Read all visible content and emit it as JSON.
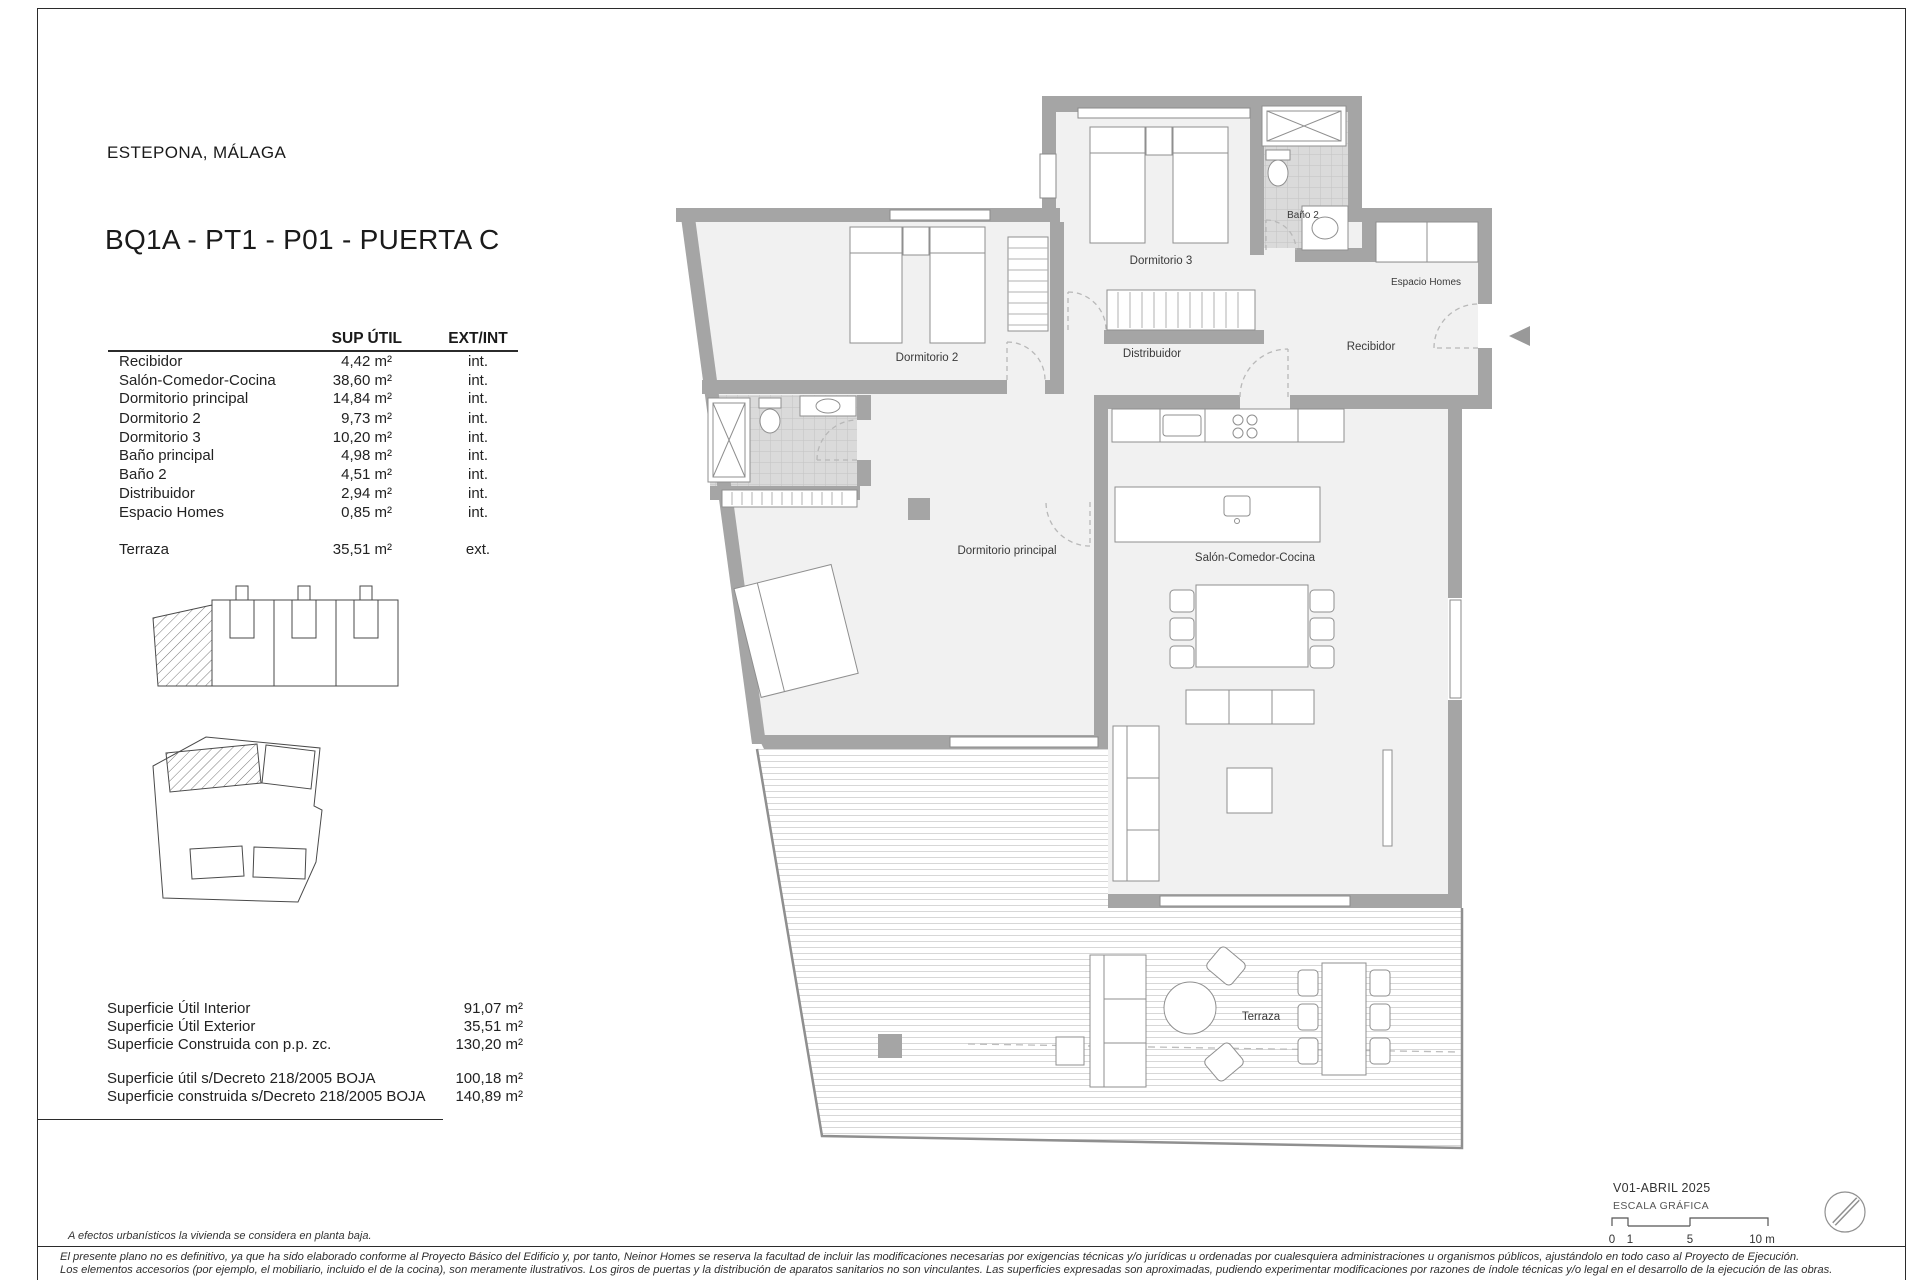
{
  "page": {
    "location": "ESTEPONA, MÁLAGA",
    "title": "BQ1A - PT1 - P01 -  PUERTA C"
  },
  "area_table": {
    "col_sup": "SUP ÚTIL",
    "col_extint": "EXT/INT",
    "rows": [
      {
        "label": "Recibidor",
        "value": "4,42 m²",
        "type": "int."
      },
      {
        "label": "Salón-Comedor-Cocina",
        "value": "38,60 m²",
        "type": "int."
      },
      {
        "label": "Dormitorio principal",
        "value": "14,84 m²",
        "type": "int."
      },
      {
        "label": "Dormitorio 2",
        "value": "9,73 m²",
        "type": "int."
      },
      {
        "label": "Dormitorio 3",
        "value": "10,20 m²",
        "type": "int."
      },
      {
        "label": "Baño principal",
        "value": "4,98 m²",
        "type": "int."
      },
      {
        "label": "Baño 2",
        "value": "4,51 m²",
        "type": "int."
      },
      {
        "label": "Distribuidor",
        "value": "2,94 m²",
        "type": "int."
      },
      {
        "label": "Espacio Homes",
        "value": "0,85 m²",
        "type": "int."
      },
      {
        "label": "Terraza",
        "value": "35,51 m²",
        "type": "ext."
      }
    ]
  },
  "summary": {
    "rows": [
      {
        "label": "Superficie Útil Interior",
        "value": "91,07  m²"
      },
      {
        "label": "Superficie Útil Exterior",
        "value": "35,51  m²"
      },
      {
        "label": "Superficie Construida con p.p. zc.",
        "value": "130,20  m²"
      },
      {
        "label": "Superficie útil s/Decreto 218/2005 BOJA",
        "value": "100,18  m²"
      },
      {
        "label": "Superficie construida s/Decreto 218/2005 BOJA",
        "value": "140,89  m²"
      }
    ]
  },
  "plan": {
    "rooms": [
      {
        "name": "Dormitorio 2"
      },
      {
        "name": "Dormitorio 3"
      },
      {
        "name": "Baño 2"
      },
      {
        "name": "Espacio Homes"
      },
      {
        "name": "Recibidor"
      },
      {
        "name": "Distribuidor"
      },
      {
        "name": "Dormitorio principal"
      },
      {
        "name": "Salón-Comedor-Cocina"
      },
      {
        "name": "Terraza"
      }
    ]
  },
  "titleblock": {
    "version": "V01-ABRIL 2025",
    "scale_label": "ESCALA GRÁFICA",
    "scale_ticks": [
      "0",
      "1",
      "5",
      "10 m"
    ]
  },
  "footer": {
    "planta_note": "A efectos urbanísticos la vivienda se considera en planta baja.",
    "disclaimer_1": "El presente plano no es definitivo, ya que ha sido elaborado conforme al Proyecto Básico del Edificio y, por tanto, Neinor Homes se reserva la facultad de incluir las modificaciones necesarias por exigencias técnicas y/o jurídicas u ordenadas por cualesquiera administraciones u organismos públicos, ajustándolo en todo caso al Proyecto de Ejecución.",
    "disclaimer_2": "Los elementos accesorios (por ejemplo, el mobiliario, incluido el de la cocina), son meramente ilustrativos. Los giros de puertas y la distribución de aparatos sanitarios no son vinculantes. Las superficies expresadas son aproximadas, pudiendo experimentar modificaciones por razones de índole técnicas y/o legal en el desarrollo de la ejecución de las obras."
  },
  "colors": {
    "wall": "#a5a5a5",
    "floor": "#f1f1f1",
    "tile": "#d9d9d9",
    "line": "#8f8f8f"
  }
}
